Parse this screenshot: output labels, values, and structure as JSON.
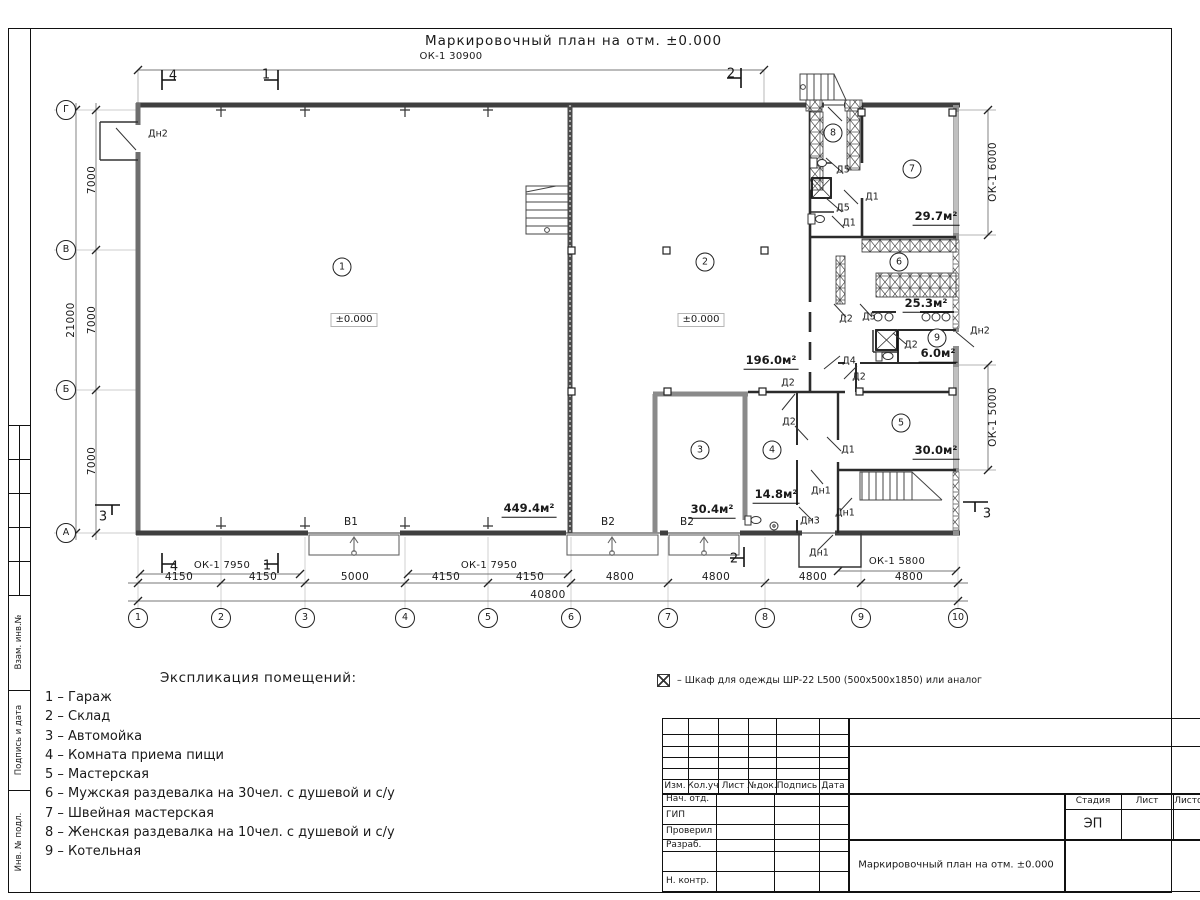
{
  "title": "Маркировочный план на отм. ±0.000",
  "legend": {
    "heading": "Экспликация помещений:",
    "items": [
      "1 – Гараж",
      "2 – Склад",
      "3 – Автомойка",
      "4 – Комната приема пищи",
      "5 – Мастерская",
      "6 – Мужская раздевалка на 30чел. с душевой и с/у",
      "7 – Швейная мастерская",
      "8 – Женская раздевалка на 10чел. с душевой и с/у",
      "9 – Котельная"
    ]
  },
  "note": "– Шкаф для одежды ШР-22 L500 (500х500х1850) или аналог",
  "plan": {
    "room_circles": [
      {
        "t": "1",
        "x": 342,
        "y": 267
      },
      {
        "t": "2",
        "x": 705,
        "y": 262
      },
      {
        "t": "3",
        "x": 700,
        "y": 450
      },
      {
        "t": "4",
        "x": 772,
        "y": 450
      },
      {
        "t": "5",
        "x": 901,
        "y": 423
      },
      {
        "t": "6",
        "x": 899,
        "y": 262
      },
      {
        "t": "7",
        "x": 912,
        "y": 169
      },
      {
        "t": "8",
        "x": 833,
        "y": 133
      },
      {
        "t": "9",
        "x": 937,
        "y": 338
      }
    ],
    "door_labels": [
      {
        "t": "Дн2",
        "x": 158,
        "y": 134
      },
      {
        "t": "Д5",
        "x": 843,
        "y": 170
      },
      {
        "t": "Д1",
        "x": 872,
        "y": 197
      },
      {
        "t": "Д5",
        "x": 843,
        "y": 208
      },
      {
        "t": "Д1",
        "x": 849,
        "y": 223
      },
      {
        "t": "Д2",
        "x": 846,
        "y": 319
      },
      {
        "t": "Д5",
        "x": 869,
        "y": 317
      },
      {
        "t": "Д2",
        "x": 911,
        "y": 345
      },
      {
        "t": "Дн2",
        "x": 980,
        "y": 331
      },
      {
        "t": "Д4",
        "x": 849,
        "y": 361
      },
      {
        "t": "Д2",
        "x": 859,
        "y": 377
      },
      {
        "t": "Д2",
        "x": 788,
        "y": 383
      },
      {
        "t": "Д2",
        "x": 789,
        "y": 422
      },
      {
        "t": "Д1",
        "x": 848,
        "y": 450
      },
      {
        "t": "Дн1",
        "x": 821,
        "y": 491
      },
      {
        "t": "Дн1",
        "x": 845,
        "y": 513
      },
      {
        "t": "Дн3",
        "x": 810,
        "y": 521
      },
      {
        "t": "Дн1",
        "x": 819,
        "y": 553
      }
    ],
    "gate_labels": [
      {
        "t": "В1",
        "x": 351,
        "y": 522
      },
      {
        "t": "В2",
        "x": 608,
        "y": 522
      },
      {
        "t": "В2",
        "x": 687,
        "y": 522
      }
    ],
    "area_labels": [
      {
        "t": "449.4м²",
        "x": 529,
        "y": 510
      },
      {
        "t": "196.0м²",
        "x": 771,
        "y": 362
      },
      {
        "t": "30.4м²",
        "x": 712,
        "y": 511
      },
      {
        "t": "14.8м²",
        "x": 776,
        "y": 496
      },
      {
        "t": "29.7м²",
        "x": 936,
        "y": 218
      },
      {
        "t": "25.3м²",
        "x": 926,
        "y": 305
      },
      {
        "t": "6.0м²",
        "x": 938,
        "y": 355
      },
      {
        "t": "30.0м²",
        "x": 936,
        "y": 452
      }
    ],
    "level_labels": [
      {
        "t": "±0.000",
        "x": 354,
        "y": 320
      },
      {
        "t": "±0.000",
        "x": 701,
        "y": 320
      }
    ],
    "section_labels": [
      {
        "t": "4",
        "x": 173,
        "y": 76
      },
      {
        "t": "1",
        "x": 266,
        "y": 75
      },
      {
        "t": "2",
        "x": 731,
        "y": 74
      },
      {
        "t": "4",
        "x": 174,
        "y": 567
      },
      {
        "t": "1",
        "x": 267,
        "y": 566
      },
      {
        "t": "2",
        "x": 734,
        "y": 559
      },
      {
        "t": "3",
        "x": 103,
        "y": 517
      },
      {
        "t": "3",
        "x": 987,
        "y": 514
      }
    ]
  },
  "dims": {
    "horizontal": [
      {
        "t": "4150",
        "x": 179,
        "y": 577
      },
      {
        "t": "4150",
        "x": 263,
        "y": 577
      },
      {
        "t": "5000",
        "x": 355,
        "y": 577
      },
      {
        "t": "4150",
        "x": 446,
        "y": 577
      },
      {
        "t": "4150",
        "x": 530,
        "y": 577
      },
      {
        "t": "4800",
        "x": 620,
        "y": 577
      },
      {
        "t": "4800",
        "x": 716,
        "y": 577
      },
      {
        "t": "4800",
        "x": 813,
        "y": 577
      },
      {
        "t": "4800",
        "x": 909,
        "y": 577
      },
      {
        "t": "40800",
        "x": 548,
        "y": 595
      }
    ],
    "vertical": [
      {
        "t": "7000",
        "x": 92,
        "y": 180
      },
      {
        "t": "7000",
        "x": 92,
        "y": 320
      },
      {
        "t": "7000",
        "x": 92,
        "y": 461
      },
      {
        "t": "21000",
        "x": 71,
        "y": 320
      },
      {
        "t": "ОК-1 6000",
        "x": 993,
        "y": 172
      },
      {
        "t": "ОК-1 5000",
        "x": 993,
        "y": 417
      }
    ],
    "window_labels": [
      {
        "t": "ОК-1 30900",
        "x": 451,
        "y": 57
      },
      {
        "t": "ОК-1 7950",
        "x": 222,
        "y": 566
      },
      {
        "t": "ОК-1 7950",
        "x": 489,
        "y": 566
      },
      {
        "t": "ОК-1 5800",
        "x": 897,
        "y": 562
      }
    ]
  },
  "axes": {
    "cols": [
      {
        "t": "1",
        "x": 138,
        "y": 618
      },
      {
        "t": "2",
        "x": 221,
        "y": 618
      },
      {
        "t": "3",
        "x": 305,
        "y": 618
      },
      {
        "t": "4",
        "x": 405,
        "y": 618
      },
      {
        "t": "5",
        "x": 488,
        "y": 618
      },
      {
        "t": "6",
        "x": 571,
        "y": 618
      },
      {
        "t": "7",
        "x": 668,
        "y": 618
      },
      {
        "t": "8",
        "x": 765,
        "y": 618
      },
      {
        "t": "9",
        "x": 861,
        "y": 618
      },
      {
        "t": "10",
        "x": 958,
        "y": 618
      }
    ],
    "rows": [
      {
        "t": "Г",
        "x": 66,
        "y": 110
      },
      {
        "t": "В",
        "x": 66,
        "y": 250
      },
      {
        "t": "Б",
        "x": 66,
        "y": 390
      },
      {
        "t": "А",
        "x": 66,
        "y": 533
      }
    ]
  },
  "titleblock": {
    "cols": [
      "Изм.",
      "Кол.уч",
      "Лист",
      "№док.",
      "Подпись",
      "Дата"
    ],
    "rows": [
      "Нач. отд.",
      "ГИП",
      "Проверил",
      "Разраб.",
      "Н. контр."
    ],
    "stage_headers": [
      "Стадия",
      "Лист",
      "Листов"
    ],
    "stage_value": "ЭП",
    "doc_title": "Маркировочный план на отм. ±0.000"
  },
  "side_stamp": [
    "Взам. инв.№",
    "Подпись и дата",
    "Инв. № подл."
  ]
}
